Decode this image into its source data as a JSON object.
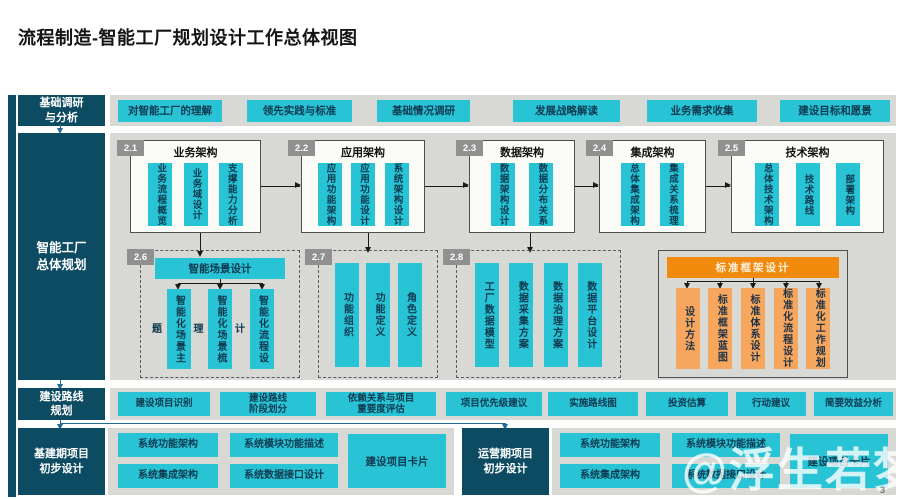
{
  "title": "流程制造-智能工厂规划设计工作总体视图",
  "page_number": "3",
  "watermark": "@浮生若梦",
  "colors": {
    "dark_label": "#0d4b63",
    "cyan": "#29c3d6",
    "strip_bg": "#d8d8d4",
    "badge_gray": "#909090",
    "orange": "#f28a0e",
    "orange_light": "#f6a75d"
  },
  "research": {
    "label": "基础调研\n与分析",
    "items": [
      "对智能工厂的理解",
      "领先实践与标准",
      "基础情况调研",
      "发展战略解读",
      "业务需求收集",
      "建设目标和愿景"
    ]
  },
  "planning": {
    "label": "智能工厂\n总体规划",
    "arch": [
      {
        "num": "2.1",
        "title": "业务架构",
        "items": [
          "业务流程概览",
          "业务域设计",
          "支撑能力分析"
        ]
      },
      {
        "num": "2.2",
        "title": "应用架构",
        "items": [
          "应用功能架构",
          "应用功能设计",
          "系统架构设计"
        ]
      },
      {
        "num": "2.3",
        "title": "数据架构",
        "items": [
          "数据架构设计",
          "数据分布关系"
        ]
      },
      {
        "num": "2.4",
        "title": "集成架构",
        "items": [
          "总体集成架构",
          "集成关系梳理"
        ]
      },
      {
        "num": "2.5",
        "title": "技术架构",
        "items": [
          "总体技术架构",
          "技术路线",
          "部署架构"
        ]
      }
    ],
    "scenario": {
      "num": "2.6",
      "header": "智能场景设计",
      "items": [
        "智能化场景主题",
        "智能化场景梳理",
        "智能化流程设计"
      ]
    },
    "function": {
      "num": "2.7",
      "items": [
        "功能组织",
        "功能定义",
        "角色定义"
      ]
    },
    "data": {
      "num": "2.8",
      "items": [
        "工厂数据模型",
        "数据采集方案",
        "数据治理方案",
        "数据平台设计"
      ]
    },
    "standard": {
      "header": "标准框架设计",
      "items": [
        "设计方法",
        "标准框架蓝图",
        "标准体系设计",
        "标准化流程设计",
        "标准化工作规划"
      ]
    }
  },
  "route": {
    "label": "建设路线\n规划",
    "items": [
      "建设项目识别",
      "建设路线\n阶段划分",
      "依赖关系与项目\n重要度评估",
      "项目优先级建议",
      "实施路线图",
      "投资估算",
      "行动建议",
      "简要效益分析"
    ]
  },
  "construction": {
    "label": "基建期项目\n初步设计",
    "items": [
      "系统功能架构",
      "系统模块功能描述",
      "系统集成架构",
      "系统数据接口设计"
    ],
    "card": "建设项目卡片"
  },
  "operation": {
    "label": "运营期项目\n初步设计",
    "items": [
      "系统功能架构",
      "系统模块功能描述",
      "系统集成架构",
      "系统数据接口设计"
    ],
    "card": "建设项目卡片"
  }
}
